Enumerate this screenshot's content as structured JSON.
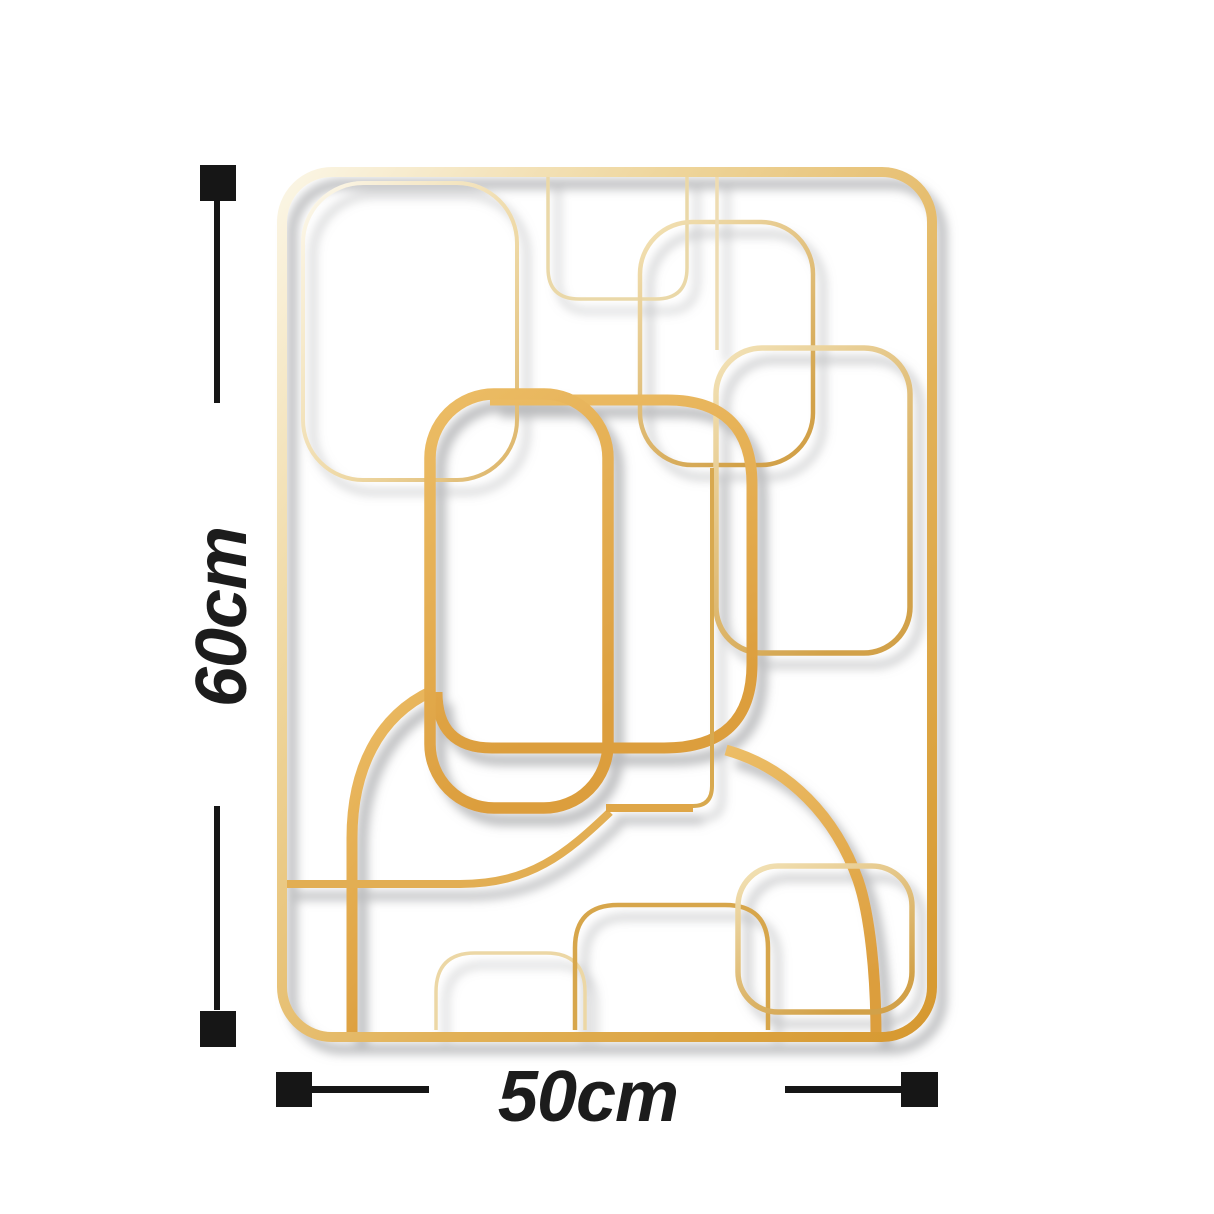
{
  "background_color": "#ffffff",
  "dimension_annotations": {
    "height": {
      "label": "60cm"
    },
    "width": {
      "label": "50cm"
    },
    "marker_color": "#161616"
  },
  "artwork": {
    "name": "abstract-gold-rounded-rectangles-wall-art",
    "colors": {
      "gold_pale": "#faf3df",
      "gold_light": "#eed59b",
      "gold_mid": "#dfb05a",
      "gold_deep": "#d6982f",
      "shadow": "#8d8f93"
    }
  }
}
